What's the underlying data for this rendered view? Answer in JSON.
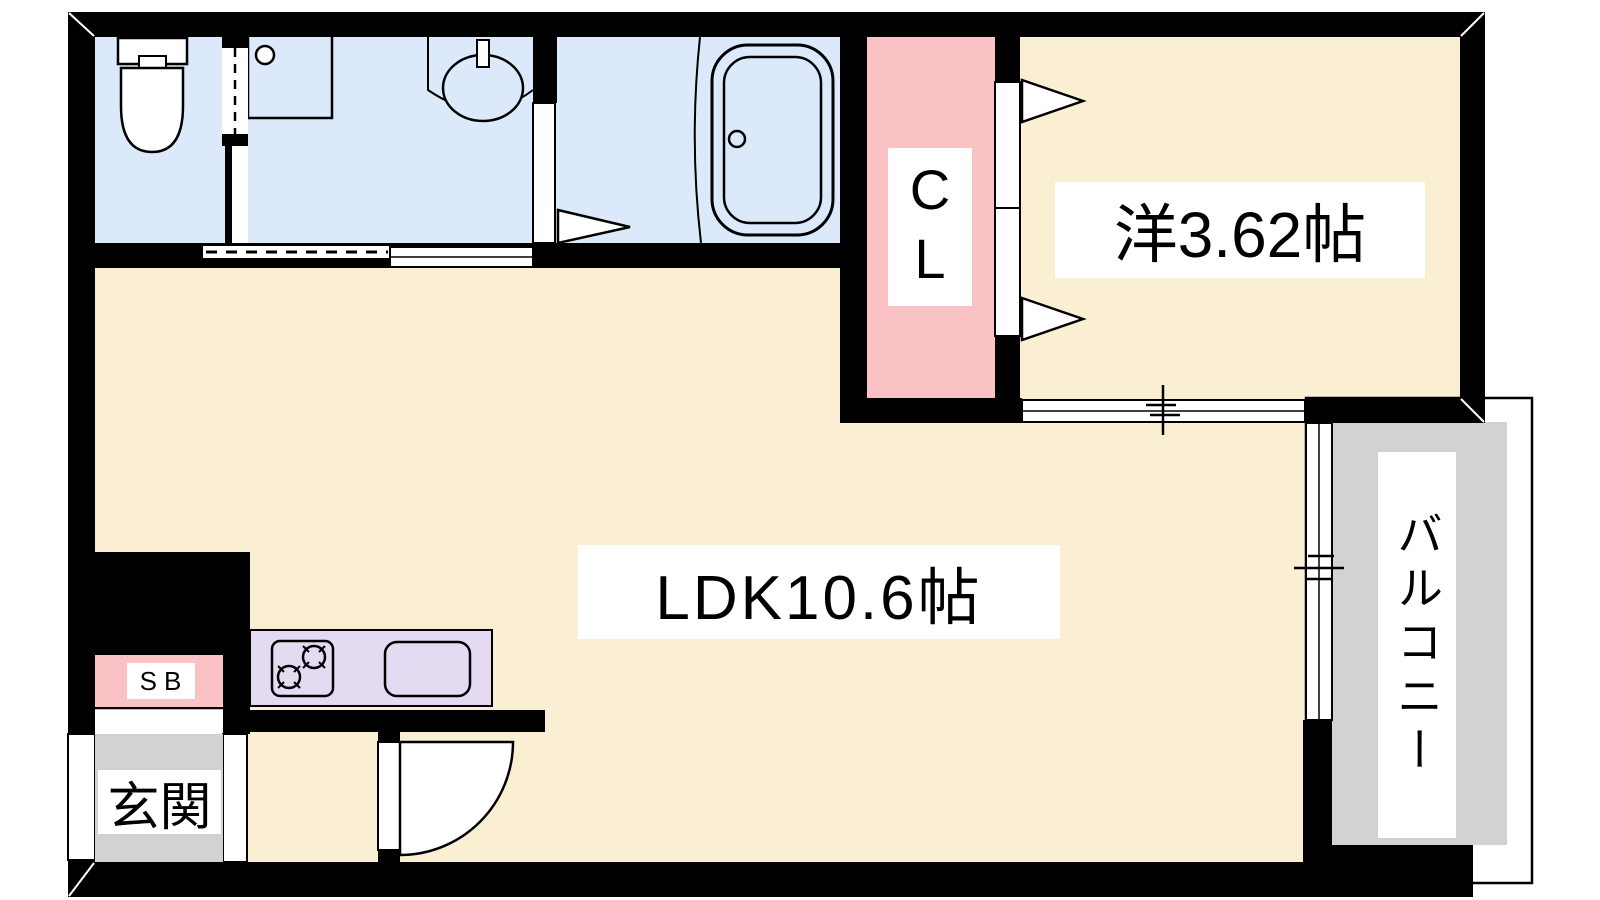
{
  "floorplan": {
    "rooms": {
      "ldk": {
        "label": "LDK10.6帖"
      },
      "western_room": {
        "label": "洋3.62帖"
      },
      "closet": {
        "label": "CL"
      },
      "entrance": {
        "label": "玄関"
      },
      "shoe_box": {
        "label": "SB"
      },
      "balcony": {
        "label": "バルコニー"
      }
    },
    "colors": {
      "floor_cream": "#FBEFD3",
      "wet_area_blue": "#DCE9FA",
      "closet_pink": "#FBC2C6",
      "kitchen_lavender": "#E4DAF2",
      "gray_area": "#D2D2D2",
      "wall_black": "#000000",
      "label_bg": "#FFFFFF"
    }
  }
}
